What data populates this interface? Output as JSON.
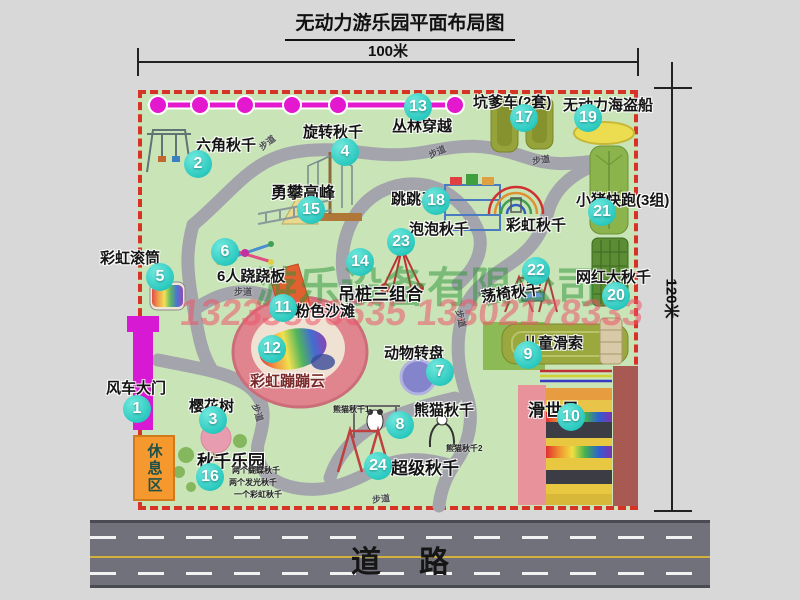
{
  "title": "无动力游乐园平面布局图",
  "dims": {
    "width_label": "100米",
    "height_label": "120米"
  },
  "road": {
    "label": "道路"
  },
  "watermark": {
    "company": "游乐设备有限公司",
    "phone": "13233806635 13302178333"
  },
  "rest_area_label": "休息区",
  "walkway_label": "步道",
  "attractions": [
    {
      "num": "1",
      "name": "风车大门"
    },
    {
      "num": "2",
      "name": "六角秋千"
    },
    {
      "num": "3",
      "name": "樱花树"
    },
    {
      "num": "4",
      "name": "旋转秋千"
    },
    {
      "num": "5",
      "name": "彩虹滚筒"
    },
    {
      "num": "6",
      "name": "6人跷跷板"
    },
    {
      "num": "7",
      "name": "动物转盘"
    },
    {
      "num": "8",
      "name": "熊猫秋千"
    },
    {
      "num": "9",
      "name": "儿童滑索"
    },
    {
      "num": "10",
      "name": "滑世界"
    },
    {
      "num": "11",
      "name": "粉色沙滩"
    },
    {
      "num": "12",
      "name": "彩虹蹦蹦云"
    },
    {
      "num": "13",
      "name": "丛林穿越"
    },
    {
      "num": "14",
      "name": "吊桩三组合"
    },
    {
      "num": "15",
      "name": "勇攀高峰"
    },
    {
      "num": "16",
      "name": "秋千乐园"
    },
    {
      "num": "17",
      "name": "坑爹车(2套)"
    },
    {
      "num": "18",
      "name": "跳跳马"
    },
    {
      "num": "19",
      "name": "无动力海盗船"
    },
    {
      "num": "20",
      "name": "网红大秋千"
    },
    {
      "num": "21",
      "name": "小猪快跑(3组)"
    },
    {
      "num": "22",
      "name": "荡椅秋千"
    },
    {
      "num": "23",
      "name": "泡泡秋千"
    },
    {
      "num": "24",
      "name": "超级秋千"
    }
  ],
  "extras": {
    "rainbow_swing": "彩虹秋千",
    "panda_swing_1": "熊猫秋千1",
    "panda_swing_2": "熊猫秋千2"
  },
  "swing_park_notes": [
    "两个蝴蝶秋千",
    "两个发光秋千",
    "一个彩虹秋千"
  ]
}
